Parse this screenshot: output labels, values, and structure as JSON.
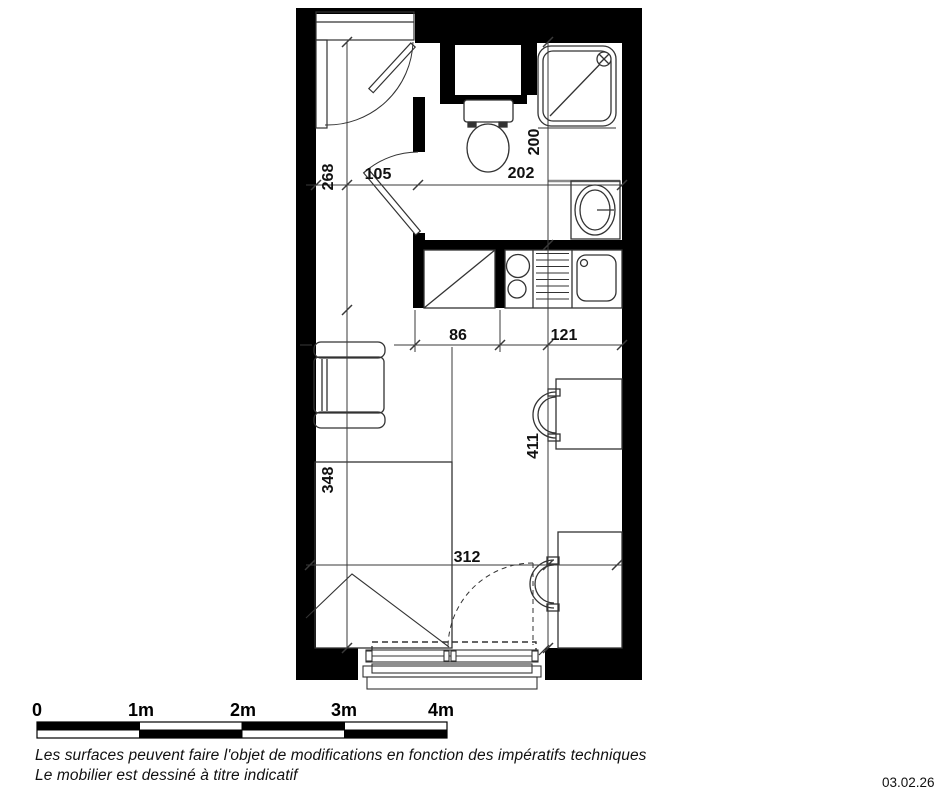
{
  "plan": {
    "dimension_labels": {
      "entry_depth": "268",
      "entry_width": "105",
      "bathroom_width": "202",
      "bathroom_depth": "200",
      "kitchen_run_left": "86",
      "kitchen_run_right": "121",
      "living_depth": "348",
      "living_depth_right": "411",
      "living_width": "312"
    }
  },
  "scale_bar": {
    "labels": [
      "0",
      "1m",
      "2m",
      "3m",
      "4m"
    ]
  },
  "footer": {
    "note_line1": "Les surfaces peuvent faire l'objet de modifications en fonction des impératifs techniques",
    "note_line2": "Le mobilier est dessiné à titre indicatif",
    "date": "03.02.26"
  },
  "colors": {
    "wall": "#000000",
    "line": "#333333",
    "background": "#ffffff"
  }
}
